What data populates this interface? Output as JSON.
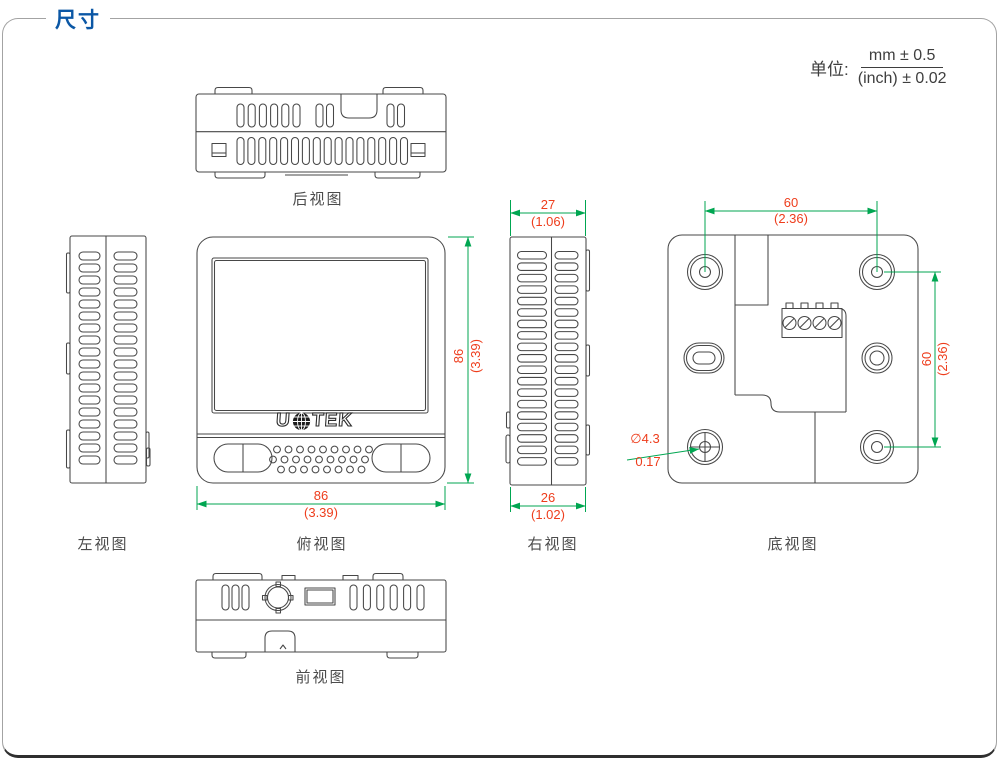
{
  "page": {
    "title": "尺寸"
  },
  "units": {
    "prefix": "单位:",
    "mm": "mm ± 0.5",
    "inch": "(inch) ± 0.02"
  },
  "logo": {
    "left": "U",
    "right": "TEK",
    "globe": "globe-icon"
  },
  "views": {
    "rear": {
      "label": "后视图"
    },
    "left": {
      "label": "左视图"
    },
    "top": {
      "label": "俯视图"
    },
    "right": {
      "label": "右视图"
    },
    "bottom": {
      "label": "底视图"
    },
    "front": {
      "label": "前视图"
    }
  },
  "dimensions": {
    "top_view_height": {
      "mm": "86",
      "inch": "(3.39)"
    },
    "top_view_width": {
      "mm": "86",
      "inch": "(3.39)"
    },
    "right_view_top": {
      "mm": "27",
      "inch": "(1.06)"
    },
    "right_view_bottom": {
      "mm": "26",
      "inch": "(1.02)"
    },
    "bottom_view_width": {
      "mm": "60",
      "inch": "(2.36)"
    },
    "bottom_view_height": {
      "mm": "60",
      "inch": "(2.36)"
    },
    "mount_hole": {
      "mm": "∅4.3",
      "inch": "0.17"
    }
  },
  "colors": {
    "dimension_line": "#00a651",
    "dimension_text": "#ee3d1c",
    "title": "#0b57a5",
    "drawing_stroke": "#474747"
  }
}
